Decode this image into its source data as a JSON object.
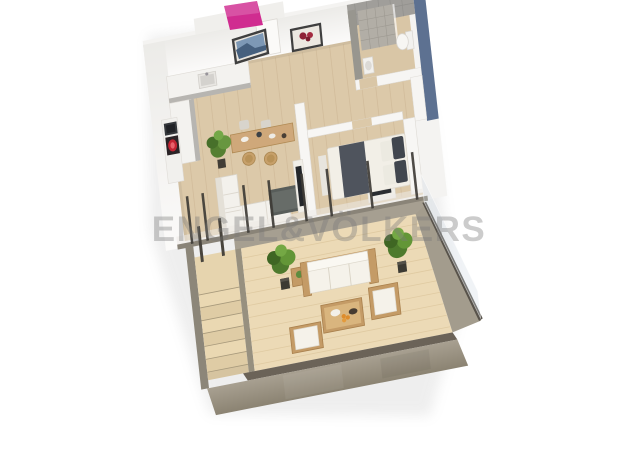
{
  "scene": {
    "watermark_text": "ENGEL&VÖLKERS",
    "colors": {
      "background": "#ffffff",
      "interior_floor": "#dcc9a9",
      "terrace_deck": "#ecdab6",
      "concrete": "#a69f91",
      "slab_face": "#9a9282",
      "wall_white": "#f6f5f3",
      "tile_gray": "#a09e9a",
      "exterior_blue": "#5d7191",
      "accent_pink": "#d02c90",
      "plant_green": "#5d8c3f",
      "rattan": "#c49b66",
      "cushion_white": "#f5f2ea",
      "bed_throw": "#4f545d",
      "dark_frame": "#3f3c37",
      "wood_table": "#cfa87a",
      "appliance_red": "#c22433",
      "watermark_gray": "rgba(122,122,122,0.38)"
    },
    "rooms": {
      "kitchen": "kitchen",
      "dining": "dining-area",
      "living": "living-room",
      "bathroom": "bathroom",
      "bedroom": "bedroom",
      "hallway": "hallway",
      "terrace": "terrace",
      "stairs": "exterior-stairs"
    }
  }
}
